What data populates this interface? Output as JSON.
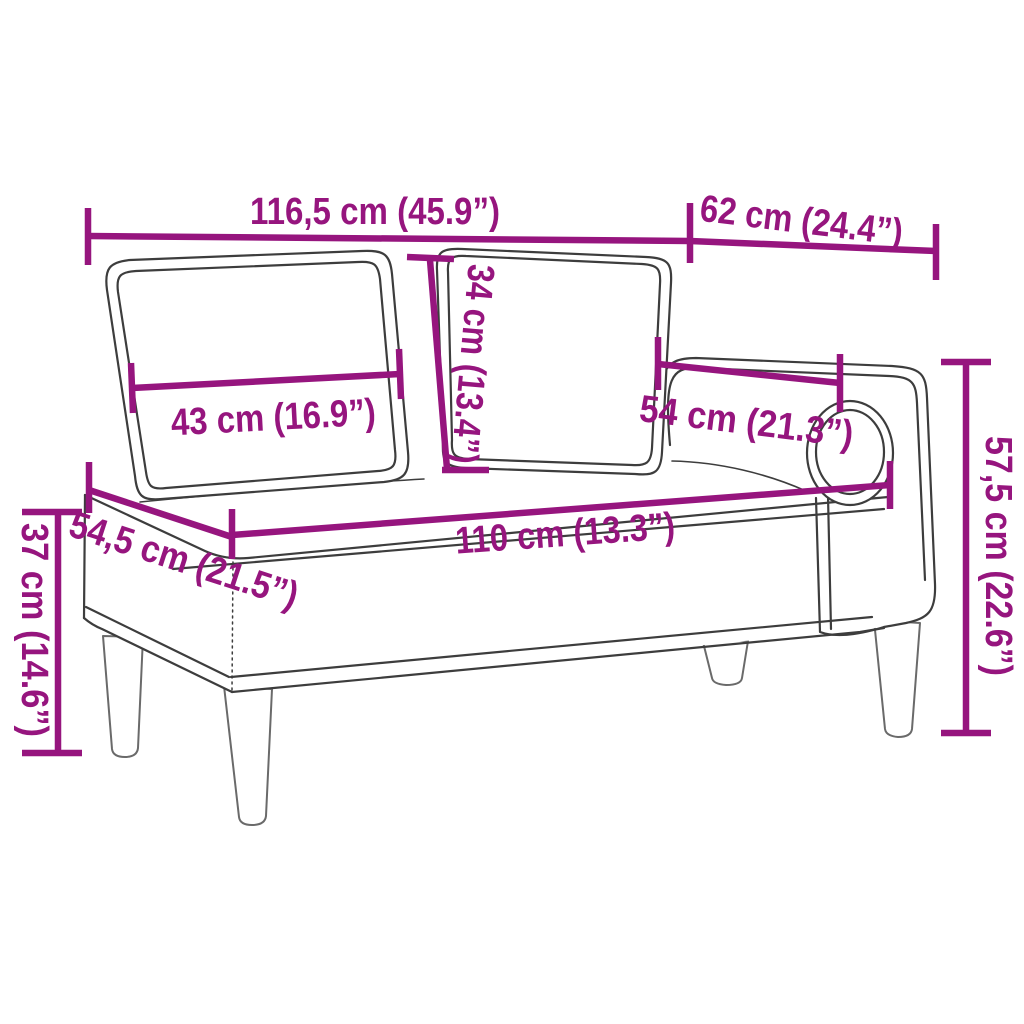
{
  "page": {
    "type": "product-dimension-diagram",
    "subject": "chaise lounge with back cushions and bolster",
    "background": "#ffffff"
  },
  "colors": {
    "dimension_accent": "#96157E",
    "line_art": "#3D3D3D",
    "legs": "#6A6A6A"
  },
  "dimensions": {
    "total_width": {
      "label": "116,5 cm (45.9”)"
    },
    "right_section_width": {
      "label": "62 cm (24.4”)"
    },
    "back_cushion_width": {
      "label": "43 cm (16.9”)"
    },
    "back_cushion_height": {
      "label": "34 cm (13.4”)"
    },
    "armrest_length": {
      "label": "54 cm (21.3”)"
    },
    "seat_length": {
      "label": "110 cm (13.3”)"
    },
    "seat_depth": {
      "label": "54,5 cm (21.5”)"
    },
    "leg_height": {
      "label": "37 cm (14.6”)"
    },
    "total_height": {
      "label": "57,5 cm (22.6”)"
    }
  }
}
